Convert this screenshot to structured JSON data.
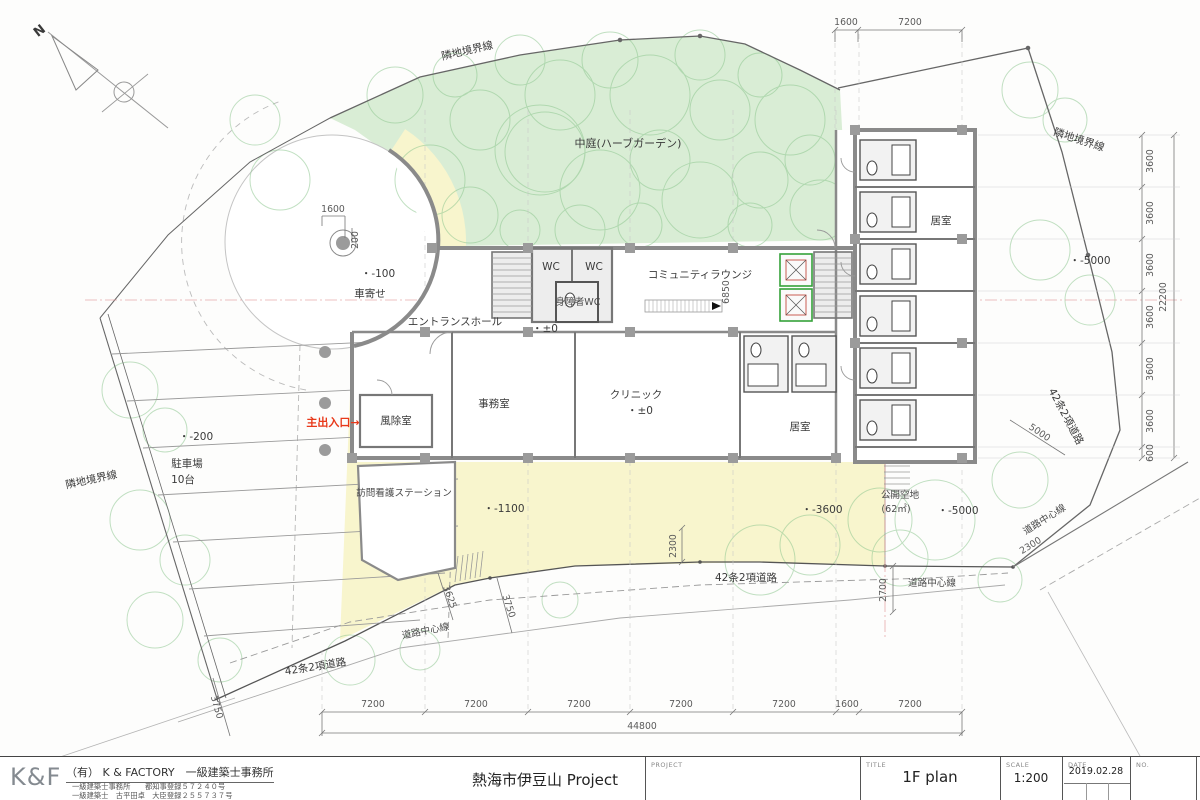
{
  "title_block": {
    "logo": "K&F",
    "firm_name": "（有） K & FACTORY　一級建築士事務所",
    "firm_reg1": "一級建築士事務所　　都知事登録５７２４０号",
    "firm_reg2": "一級建築士　古平田卓　大臣登録２５５７３７号",
    "project_label": "PROJECT",
    "project_name": "熱海市伊豆山 Project",
    "title_label": "TITLE",
    "title_value": "1F plan",
    "scale_label": "SCALE",
    "scale_value": "1:200",
    "date_label": "DATE",
    "date_value": "2019.02.28",
    "no_label": "NO."
  },
  "compass": {
    "north": "N"
  },
  "labels": {
    "courtyard": "中庭(ハーブガーデン)",
    "boundary_top": "隣地境界線",
    "boundary_right": "隣地境界線",
    "boundary_left": "隣地境界線",
    "carport": "車寄せ",
    "entrance_hall": "エントランスホール",
    "wc_left": "WC",
    "wc_right": "WC",
    "accessible_wc": "身障者WC",
    "community_lounge": "コミュニティラウンジ",
    "office": "事務室",
    "clinic": "クリニック",
    "windbreak_room": "風除室",
    "room_south": "居室",
    "room_east": "居室",
    "nursing_station": "訪問看護ステーション",
    "parking": "駐車場",
    "parking_capacity": "10台",
    "open_space": "公開空地",
    "open_space_area": "(62㎡)",
    "main_entrance": "主出入口→",
    "road_42_south": "42条2項道路",
    "road_42_sw": "42条2項道路",
    "road_42_east": "42条2項道路",
    "road_center_south": "道路中心線",
    "road_center_sw": "道路中心線",
    "road_center_east": "道路中心線"
  },
  "levels": {
    "carport": "・-100",
    "hall": "・±0",
    "clinic": "・±0",
    "parking": "・-200",
    "south_walk": "・-1100",
    "south_road": "・-3600",
    "east_upper": "・-5000",
    "open_space": "・-5000"
  },
  "dims": {
    "top": [
      "1600",
      "7200"
    ],
    "right": [
      "3600",
      "3600",
      "3600",
      "3600",
      "3600",
      "3600",
      "600"
    ],
    "right_total": "22200",
    "bottom": [
      "7200",
      "7200",
      "7200",
      "7200",
      "7200",
      "1600",
      "7200"
    ],
    "bottom_total": "44800",
    "lounge_depth": "6850",
    "court_width": "1600",
    "court_offset": "200",
    "green_depth": "2300",
    "road_east_width": "2700",
    "stair_width": "3625",
    "walk_width": "3750",
    "sw_road_width": "3750",
    "east_road_5000": "5000",
    "east_road_2300": "2300"
  }
}
